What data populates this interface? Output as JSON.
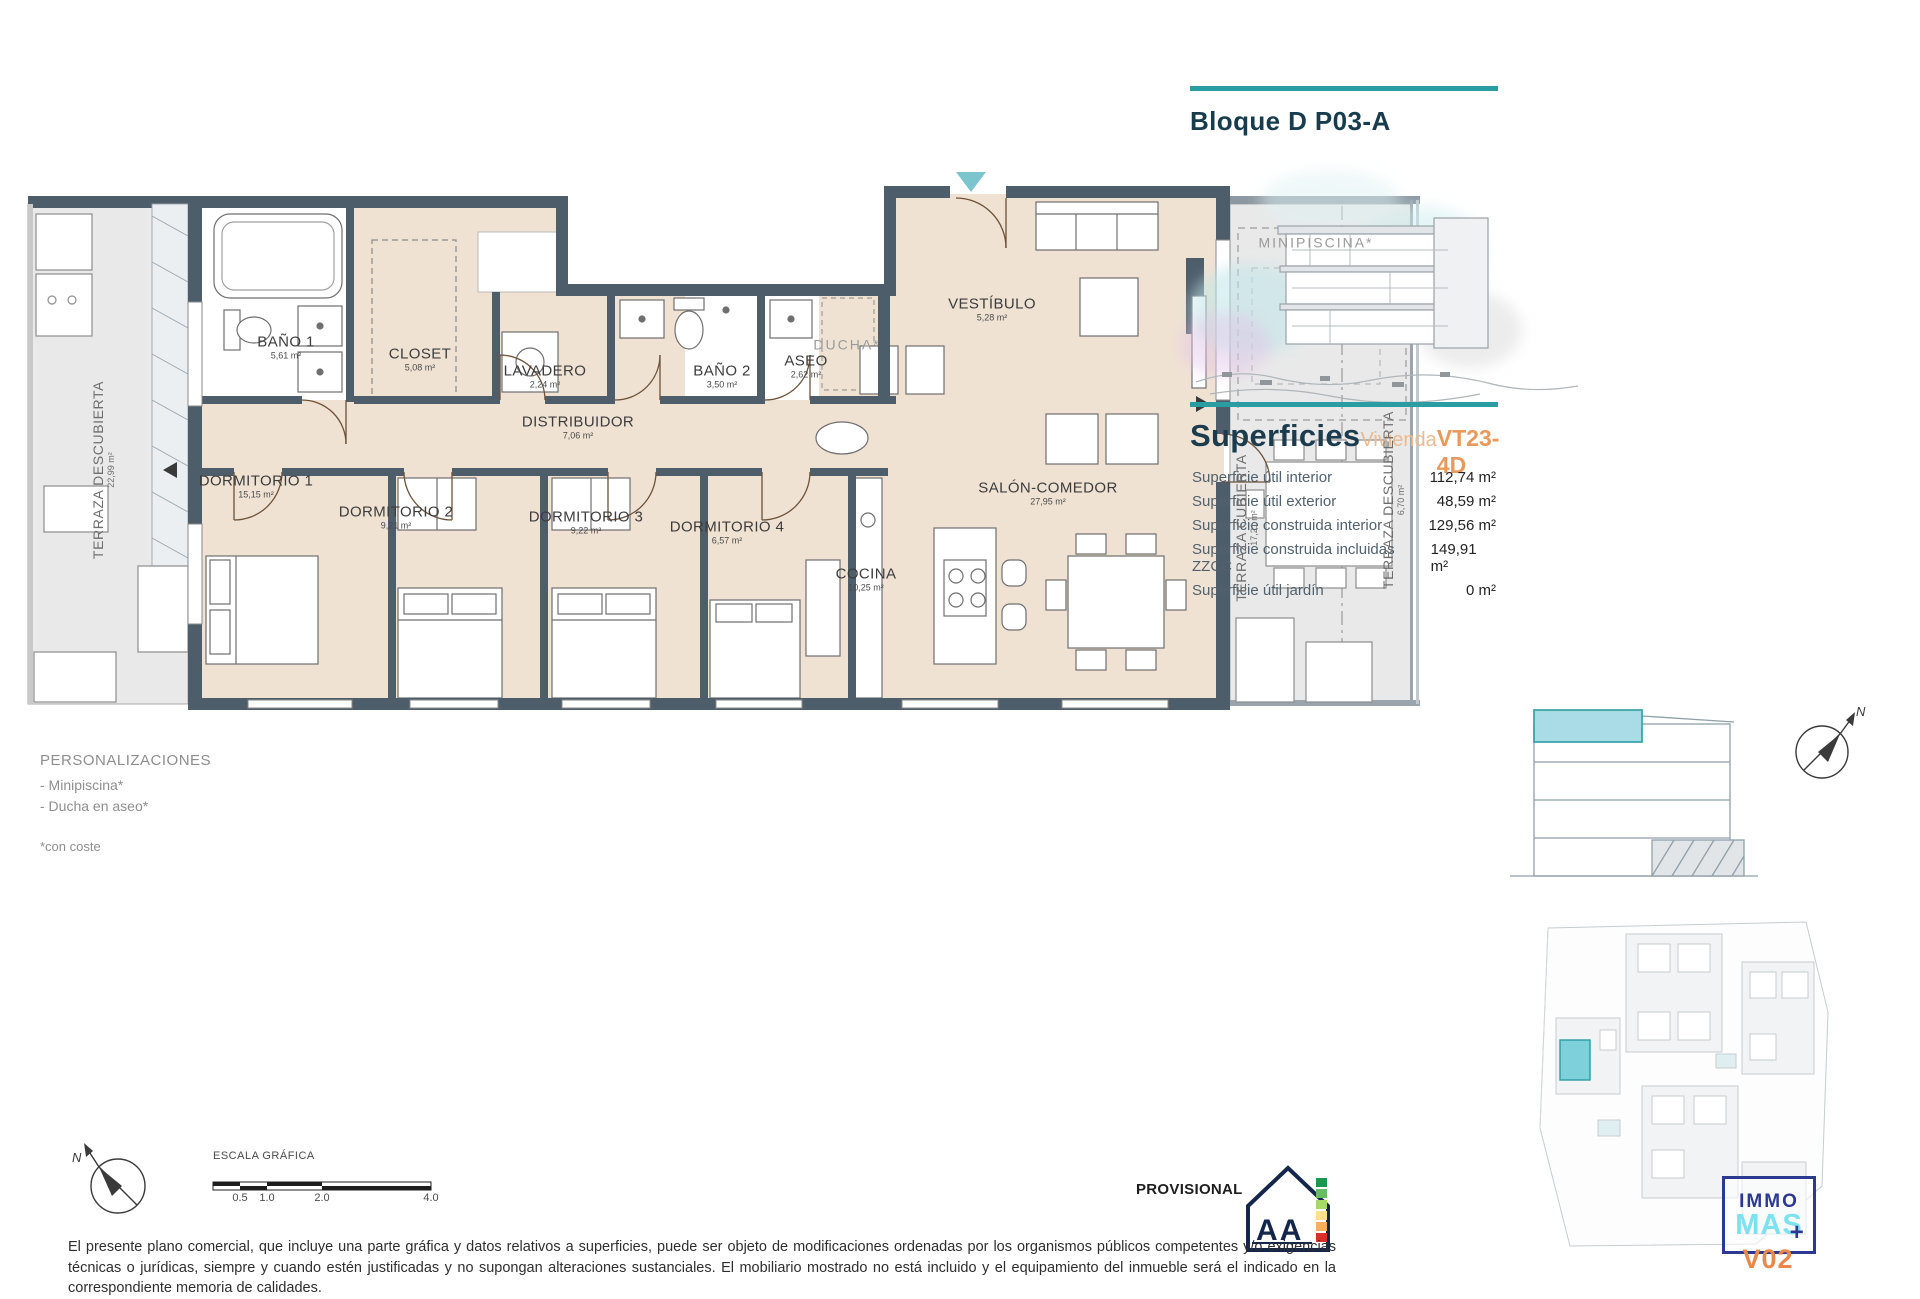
{
  "right_panel": {
    "block_title": "Bloque D P03-A",
    "superficies": {
      "heading": "Superficies",
      "category": "Vivienda",
      "unit_code": "VT23-4D",
      "rows": [
        {
          "label": "Superficie útil interior",
          "value": "112,74 m²"
        },
        {
          "label": "Superficie útil exterior",
          "value": "48,59 m²"
        },
        {
          "label": "Superficie construida interior",
          "value": "129,56 m²"
        },
        {
          "label": "Superficie construida incluidas ZZCC",
          "value": "149,91 m²"
        },
        {
          "label": "Superficie útil jardín",
          "value": "0 m²"
        }
      ]
    }
  },
  "plan": {
    "compass_letter": "N",
    "rooms": [
      {
        "name": "BAÑO 1",
        "area": "5,61 m²",
        "x": 286,
        "y": 348,
        "kind": "room"
      },
      {
        "name": "CLOSET",
        "area": "5,08 m²",
        "x": 420,
        "y": 360,
        "kind": "room"
      },
      {
        "name": "LAVADERO",
        "area": "2,24 m²",
        "x": 545,
        "y": 377,
        "kind": "room"
      },
      {
        "name": "BAÑO 2",
        "area": "3,50 m²",
        "x": 722,
        "y": 377,
        "kind": "room"
      },
      {
        "name": "ASEO",
        "area": "2,62 m²",
        "x": 806,
        "y": 367,
        "kind": "room"
      },
      {
        "name": "DUCHA*",
        "area": "",
        "x": 847,
        "y": 345,
        "kind": "option"
      },
      {
        "name": "VESTÍBULO",
        "area": "5,28 m²",
        "x": 992,
        "y": 310,
        "kind": "room"
      },
      {
        "name": "DISTRIBUIDOR",
        "area": "7,06 m²",
        "x": 578,
        "y": 428,
        "kind": "room"
      },
      {
        "name": "DORMITORIO 1",
        "area": "15,15 m²",
        "x": 256,
        "y": 487,
        "kind": "room"
      },
      {
        "name": "DORMITORIO 2",
        "area": "9,21 m²",
        "x": 396,
        "y": 518,
        "kind": "room"
      },
      {
        "name": "DORMITORIO 3",
        "area": "9,22 m²",
        "x": 586,
        "y": 523,
        "kind": "room"
      },
      {
        "name": "DORMITORIO 4",
        "area": "6,57 m²",
        "x": 727,
        "y": 533,
        "kind": "room"
      },
      {
        "name": "COCINA",
        "area": "10,25 m²",
        "x": 866,
        "y": 580,
        "kind": "room"
      },
      {
        "name": "SALÓN-COMEDOR",
        "area": "27,95 m²",
        "x": 1048,
        "y": 494,
        "kind": "room"
      },
      {
        "name": "TERRAZA CUBIERTA",
        "area": "17,21 m²",
        "x": 1247,
        "y": 528,
        "kind": "terrace",
        "rot": true
      },
      {
        "name": "TERRAZA DESCUBIERTA",
        "area": "6,70 m²",
        "x": 1394,
        "y": 500,
        "kind": "terrace",
        "rot": true
      },
      {
        "name": "TERRAZA DESCUBIERTA",
        "area": "22,99 m²",
        "x": 104,
        "y": 470,
        "kind": "terrace",
        "rot": true
      },
      {
        "name": "MINIPISCINA*",
        "area": "",
        "x": 1316,
        "y": 243,
        "kind": "option"
      }
    ]
  },
  "personalizaciones": {
    "heading": "PERSONALIZACIONES",
    "items": [
      "- Minipiscina*",
      "- Ducha en aseo*"
    ],
    "footnote": "*con coste"
  },
  "footer": {
    "scale_label": "ESCALA GRÁFICA",
    "scale_ticks": [
      "0.5",
      "1.0",
      "2.0",
      "4.0"
    ],
    "provisional": "PROVISIONAL",
    "energy_letters": "A A",
    "disclaimer": "El presente plano comercial, que incluye una parte gráfica y datos relativos a superficies, puede ser objeto de modificaciones ordenadas por los organismos públicos competentes y/o exigencias técnicas o jurídicas, siempre y cuando estén justificadas y no supongan alteraciones sustanciales. El mobiliario mostrado no está incluido y el equipamiento del inmueble será el indicado en la correspondiente memoria de calidades."
  },
  "logo": {
    "immo": "IMMO",
    "mas": "MAS",
    "plus": "+",
    "version": "V02"
  },
  "colors": {
    "accent_teal": "#2a9da3",
    "orange": "#e8995c",
    "light_orange": "#e9bb90",
    "wall": "#4e5d6a",
    "interior": "#f0e2d3",
    "terrace": "#e9e9e9",
    "section_highlight": "#a9dce6",
    "logo_navy": "#2b3990",
    "logo_cyan": "#7de2f0",
    "logo_orange": "#e8884a"
  }
}
